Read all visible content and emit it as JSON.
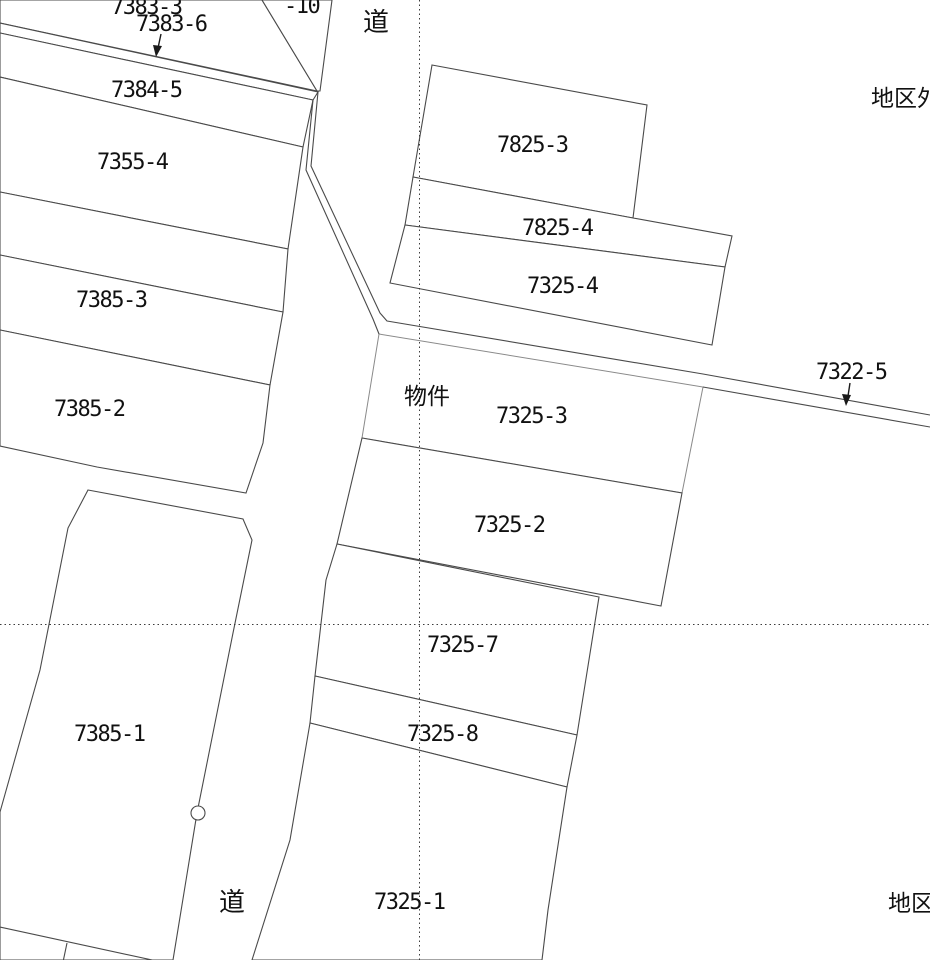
{
  "map_type": "cadastral-parcel-map",
  "colors": {
    "background": "#ffffff",
    "line": "#4a4a4a",
    "highlight": "#f8afc8",
    "text": "#111111"
  },
  "highlight_parcel": {
    "number": "7325-3",
    "marker": "物件"
  },
  "labels": [
    {
      "id": "parcel-7383-3",
      "text": "7383-3"
    },
    {
      "id": "parcel-7383-6",
      "text": "7383-6"
    },
    {
      "id": "parcel-minus-10",
      "text": "-10"
    },
    {
      "id": "road-top",
      "text": "道"
    },
    {
      "id": "parcel-7384-5",
      "text": "7384-5"
    },
    {
      "id": "parcel-7825-3",
      "text": "7825-3"
    },
    {
      "id": "district-top",
      "text": "地区外"
    },
    {
      "id": "parcel-7355-4",
      "text": "7355-4"
    },
    {
      "id": "parcel-7825-4",
      "text": "7825-4"
    },
    {
      "id": "parcel-7325-4",
      "text": "7325-4"
    },
    {
      "id": "parcel-7385-3",
      "text": "7385-3"
    },
    {
      "id": "parcel-7322-5",
      "text": "7322-5"
    },
    {
      "id": "property-marker",
      "text": "物件"
    },
    {
      "id": "parcel-7325-3",
      "text": "7325-3"
    },
    {
      "id": "parcel-7385-2",
      "text": "7385-2"
    },
    {
      "id": "parcel-7325-2",
      "text": "7325-2"
    },
    {
      "id": "parcel-7325-7",
      "text": "7325-7"
    },
    {
      "id": "parcel-7385-1",
      "text": "7385-1"
    },
    {
      "id": "parcel-7325-8",
      "text": "7325-8"
    },
    {
      "id": "road-bottom",
      "text": "道"
    },
    {
      "id": "parcel-7325-1",
      "text": "7325-1"
    },
    {
      "id": "district-bottom",
      "text": "地区外"
    }
  ]
}
